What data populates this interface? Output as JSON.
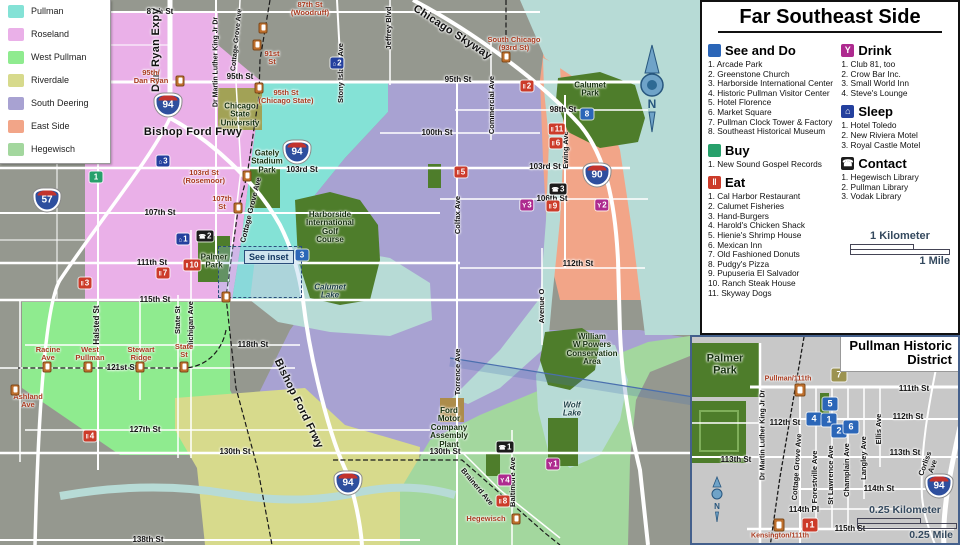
{
  "colors": {
    "see": "#2b66b8",
    "see7": "#9c9350",
    "buy": "#27a06b",
    "eat": "#cc3b2a",
    "drink": "#ae2a8f",
    "sleep": "#24409e",
    "contact": "#1c1c1c",
    "station": "#c0702d"
  },
  "marker_glyphs": {
    "see": "",
    "see7": "",
    "buy": "",
    "eat": "‖",
    "drink": "Y",
    "sleep": "⌂",
    "contact": "☎"
  },
  "legend": {
    "items": [
      {
        "label": "Pullman",
        "color": "#84e2d6"
      },
      {
        "label": "Roseland",
        "color": "#eab0e8"
      },
      {
        "label": "West Pullman",
        "color": "#8feb8f"
      },
      {
        "label": "Riverdale",
        "color": "#d7da8c"
      },
      {
        "label": "South Deering",
        "color": "#a8a2d2"
      },
      {
        "label": "East Side",
        "color": "#f2a588"
      },
      {
        "label": "Hegewisch",
        "color": "#a3d79e"
      }
    ]
  },
  "panel": {
    "title": "Far Southeast Side",
    "sections": [
      {
        "key": "see",
        "col": "left",
        "title": "See and Do",
        "color": "#2b66b8",
        "glyph": "",
        "items": [
          "Arcade Park",
          "Greenstone Church",
          "Harborside International Center",
          "Historic Pullman Visitor Center",
          "Hotel Florence",
          "Market Square",
          "Pullman Clock Tower & Factory",
          "Southeast Historical Museum"
        ]
      },
      {
        "key": "buy",
        "col": "left",
        "title": "Buy",
        "color": "#27a06b",
        "glyph": "",
        "items": [
          "New Sound Gospel Records"
        ]
      },
      {
        "key": "eat",
        "col": "left",
        "title": "Eat",
        "color": "#cc3b2a",
        "glyph": "‖",
        "items": [
          "Cal Harbor Restaurant",
          "Calumet Fisheries",
          "Hand-Burgers",
          "Harold's Chicken Shack",
          "Hienie's Shrimp House",
          "Mexican Inn",
          "Old Fashioned Donuts",
          "Pudgy's Pizza",
          "Pupuseria El Salvador",
          "Ranch Steak House",
          "Skyway Dogs"
        ]
      },
      {
        "key": "drink",
        "col": "right",
        "title": "Drink",
        "color": "#ae2a8f",
        "glyph": "Y",
        "items": [
          "Club 81, too",
          "Crow Bar Inc.",
          "Small World Inn",
          "Steve's Lounge"
        ]
      },
      {
        "key": "sleep",
        "col": "right",
        "title": "Sleep",
        "color": "#24409e",
        "glyph": "⌂",
        "items": [
          "Hotel Toledo",
          "New Riviera Motel",
          "Royal Castle Motel"
        ]
      },
      {
        "key": "contact",
        "col": "right",
        "title": "Contact",
        "color": "#1c1c1c",
        "glyph": "☎",
        "items": [
          "Hegewisch Library",
          "Pullman Library",
          "Vodak Library"
        ]
      }
    ],
    "scale": {
      "km": "1 Kilometer",
      "mile": "1 Mile"
    }
  },
  "map": {
    "compass_n": "N",
    "see_inset_label": "See inset",
    "labels": [
      {
        "t": "87th St",
        "x": 160,
        "y": 12
      },
      {
        "t": "95th St",
        "x": 240,
        "y": 77
      },
      {
        "t": "95th St",
        "x": 458,
        "y": 80
      },
      {
        "t": "98th St",
        "x": 563,
        "y": 110
      },
      {
        "t": "100th St",
        "x": 437,
        "y": 133
      },
      {
        "t": "103rd St",
        "x": 302,
        "y": 170
      },
      {
        "t": "103rd St",
        "x": 545,
        "y": 167
      },
      {
        "t": "106th St",
        "x": 552,
        "y": 199
      },
      {
        "t": "107th St",
        "x": 160,
        "y": 213
      },
      {
        "t": "111th St",
        "x": 152,
        "y": 263
      },
      {
        "t": "112th St",
        "x": 578,
        "y": 264
      },
      {
        "t": "115th St",
        "x": 155,
        "y": 300
      },
      {
        "t": "118th St",
        "x": 253,
        "y": 345
      },
      {
        "t": "121st St",
        "x": 122,
        "y": 368
      },
      {
        "t": "127th St",
        "x": 145,
        "y": 430
      },
      {
        "t": "130th St",
        "x": 235,
        "y": 452
      },
      {
        "t": "130th St",
        "x": 445,
        "y": 452
      },
      {
        "t": "138th St",
        "x": 148,
        "y": 540
      },
      {
        "t": "Halsted St",
        "x": 97,
        "y": 325,
        "r": -90
      },
      {
        "t": "State St",
        "x": 178,
        "y": 320,
        "r": -90,
        "f": 7.5
      },
      {
        "t": "Michigan Ave",
        "x": 191,
        "y": 325,
        "r": -90,
        "f": 7.5
      },
      {
        "t": "Dr Martin Luther King Jr Dr",
        "x": 216,
        "y": 62,
        "r": -90,
        "f": 7
      },
      {
        "t": "Stony Island Ave",
        "x": 341,
        "y": 73,
        "r": -90,
        "f": 7.5
      },
      {
        "t": "Jeffrey Blvd",
        "x": 389,
        "y": 28,
        "r": -90,
        "f": 7.5
      },
      {
        "t": "Commercial Ave",
        "x": 492,
        "y": 105,
        "r": -90,
        "f": 7.5
      },
      {
        "t": "Ewing Ave",
        "x": 566,
        "y": 150,
        "r": -90,
        "f": 7.5
      },
      {
        "t": "Colfax Ave",
        "x": 458,
        "y": 215,
        "r": -90,
        "f": 7.5
      },
      {
        "t": "Torrence Ave",
        "x": 458,
        "y": 372,
        "r": -90,
        "f": 7.5
      },
      {
        "t": "Avenue O",
        "x": 542,
        "y": 306,
        "r": -90,
        "f": 7.5
      },
      {
        "t": "Baltimore Ave",
        "x": 513,
        "y": 482,
        "r": -90,
        "f": 7.5
      },
      {
        "t": "Brainerd Ave",
        "x": 477,
        "y": 487,
        "r": 50,
        "f": 7.5
      },
      {
        "t": "Cottage Grove Ave",
        "x": 237,
        "y": 40,
        "r": -84,
        "f": 7
      },
      {
        "t": "Cottage Grove Ave",
        "x": 251,
        "y": 210,
        "r": -76,
        "f": 7.5
      },
      {
        "t": "Dan Ryan Expy",
        "x": 157,
        "y": 50,
        "r": -90,
        "c": "ex"
      },
      {
        "t": "Bishop Ford Frwy",
        "x": 193,
        "y": 133,
        "c": "ex"
      },
      {
        "t": "Bishop Ford Frwy",
        "x": 298,
        "y": 404,
        "r": 64,
        "c": "ex"
      },
      {
        "t": "Chicago Skyway",
        "x": 452,
        "y": 33,
        "r": 33,
        "c": "ex"
      },
      {
        "t": "95th/\nDan Ryan",
        "x": 151,
        "y": 77,
        "c": "stn"
      },
      {
        "t": "87th St\n(Woodruff)",
        "x": 310,
        "y": 9,
        "c": "stn"
      },
      {
        "t": "91st\nSt",
        "x": 272,
        "y": 58,
        "c": "stn"
      },
      {
        "t": "95th St\n(Chicago State)",
        "x": 286,
        "y": 97,
        "c": "stn"
      },
      {
        "t": "103rd St\n(Rosemoor)",
        "x": 204,
        "y": 177,
        "c": "stn"
      },
      {
        "t": "107th\nSt",
        "x": 222,
        "y": 203,
        "c": "stn"
      },
      {
        "t": "South Chicago\n(93rd St)",
        "x": 514,
        "y": 44,
        "c": "stn"
      },
      {
        "t": "Racine\nAve",
        "x": 48,
        "y": 354,
        "c": "stn"
      },
      {
        "t": "West\nPullman",
        "x": 90,
        "y": 354,
        "c": "stn"
      },
      {
        "t": "Stewart\nRidge",
        "x": 141,
        "y": 354,
        "c": "stn"
      },
      {
        "t": "State\nSt",
        "x": 184,
        "y": 351,
        "c": "stn"
      },
      {
        "t": "Ashland\nAve",
        "x": 28,
        "y": 401,
        "c": "stn"
      },
      {
        "t": "Hegewisch",
        "x": 486,
        "y": 519,
        "c": "stn"
      },
      {
        "t": "Chicago\nState\nUniversity",
        "x": 240,
        "y": 115,
        "c": "ar"
      },
      {
        "t": "Gately\nStadium\nPark",
        "x": 267,
        "y": 162,
        "c": "ar"
      },
      {
        "t": "Palmer\nPark",
        "x": 214,
        "y": 262,
        "c": "ar"
      },
      {
        "t": "Harborside\nInternational\nGolf\nCourse",
        "x": 330,
        "y": 228,
        "c": "ar"
      },
      {
        "t": "Calumet\nPark",
        "x": 590,
        "y": 90,
        "c": "ar"
      },
      {
        "t": "William\nW Powers\nConservation\nArea",
        "x": 592,
        "y": 350,
        "c": "ar"
      },
      {
        "t": "Ford\nMotor\nCompany\nAssembly\nPlant",
        "x": 449,
        "y": 428,
        "c": "ar"
      },
      {
        "t": "Calumet\nLake",
        "x": 330,
        "y": 292,
        "c": "wa"
      },
      {
        "t": "Wolf\nLake",
        "x": 572,
        "y": 410,
        "c": "wa"
      }
    ],
    "stations": [
      {
        "x": 180,
        "y": 81
      },
      {
        "x": 263,
        "y": 28
      },
      {
        "x": 257,
        "y": 45
      },
      {
        "x": 259,
        "y": 88
      },
      {
        "x": 247,
        "y": 176
      },
      {
        "x": 238,
        "y": 208
      },
      {
        "x": 506,
        "y": 57
      },
      {
        "x": 47,
        "y": 367
      },
      {
        "x": 88,
        "y": 367
      },
      {
        "x": 140,
        "y": 367
      },
      {
        "x": 184,
        "y": 367
      },
      {
        "x": 15,
        "y": 390
      },
      {
        "x": 516,
        "y": 519
      },
      {
        "x": 226,
        "y": 297
      }
    ],
    "markers": [
      {
        "t": "see",
        "n": "3",
        "x": 302,
        "y": 255
      },
      {
        "t": "see",
        "n": "8",
        "x": 587,
        "y": 114
      },
      {
        "t": "buy",
        "n": "1",
        "x": 96,
        "y": 177
      },
      {
        "t": "eat",
        "n": "2",
        "x": 527,
        "y": 86
      },
      {
        "t": "eat",
        "n": "11",
        "x": 557,
        "y": 129
      },
      {
        "t": "eat",
        "n": "6",
        "x": 556,
        "y": 143
      },
      {
        "t": "eat",
        "n": "5",
        "x": 461,
        "y": 172
      },
      {
        "t": "eat",
        "n": "9",
        "x": 553,
        "y": 206
      },
      {
        "t": "eat",
        "n": "3",
        "x": 85,
        "y": 283
      },
      {
        "t": "eat",
        "n": "10",
        "x": 192,
        "y": 265
      },
      {
        "t": "eat",
        "n": "7",
        "x": 163,
        "y": 273
      },
      {
        "t": "eat",
        "n": "4",
        "x": 90,
        "y": 436
      },
      {
        "t": "eat",
        "n": "8",
        "x": 503,
        "y": 501
      },
      {
        "t": "drink",
        "n": "3",
        "x": 527,
        "y": 205
      },
      {
        "t": "drink",
        "n": "2",
        "x": 602,
        "y": 205
      },
      {
        "t": "drink",
        "n": "1",
        "x": 553,
        "y": 464
      },
      {
        "t": "drink",
        "n": "4",
        "x": 505,
        "y": 480
      },
      {
        "t": "sleep",
        "n": "2",
        "x": 337,
        "y": 63
      },
      {
        "t": "sleep",
        "n": "3",
        "x": 163,
        "y": 161
      },
      {
        "t": "sleep",
        "n": "1",
        "x": 183,
        "y": 239
      },
      {
        "t": "contact",
        "n": "2",
        "x": 205,
        "y": 236
      },
      {
        "t": "contact",
        "n": "3",
        "x": 558,
        "y": 189
      },
      {
        "t": "contact",
        "n": "1",
        "x": 505,
        "y": 447
      }
    ],
    "shields": [
      {
        "n": "94",
        "x": 168,
        "y": 105
      },
      {
        "n": "57",
        "x": 47,
        "y": 200
      },
      {
        "n": "94",
        "x": 297,
        "y": 152
      },
      {
        "n": "90",
        "x": 597,
        "y": 175
      },
      {
        "n": "94",
        "x": 348,
        "y": 483
      }
    ]
  },
  "inset": {
    "title": "Pullman Historic\nDistrict",
    "compass_n": "N",
    "scale": {
      "km": "0.25 Kilometer",
      "mile": "0.25 Mile"
    },
    "labels": [
      {
        "t": "111th St",
        "x": 222,
        "y": 52
      },
      {
        "t": "112th St",
        "x": 216,
        "y": 80
      },
      {
        "t": "112th St",
        "x": 93,
        "y": 86
      },
      {
        "t": "113th St",
        "x": 213,
        "y": 116
      },
      {
        "t": "113th St",
        "x": 44,
        "y": 123
      },
      {
        "t": "114th St",
        "x": 187,
        "y": 152
      },
      {
        "t": "114th Pl",
        "x": 112,
        "y": 173
      },
      {
        "t": "115th St",
        "x": 158,
        "y": 192
      },
      {
        "t": "Dr Martin Luther King Jr Dr",
        "x": 71,
        "y": 98,
        "r": -90,
        "f": 7
      },
      {
        "t": "Cottage Grove Ave",
        "x": 105,
        "y": 130,
        "r": -86,
        "f": 7.5
      },
      {
        "t": "Forestville Ave",
        "x": 123,
        "y": 140,
        "r": -90,
        "f": 7.5
      },
      {
        "t": "St Lawrence Ave",
        "x": 139,
        "y": 138,
        "r": -90,
        "f": 7.5
      },
      {
        "t": "Champlain Ave",
        "x": 155,
        "y": 133,
        "r": -90,
        "f": 7.5
      },
      {
        "t": "Langley Ave",
        "x": 172,
        "y": 121,
        "r": -90,
        "f": 7.5
      },
      {
        "t": "Ellis Ave",
        "x": 187,
        "y": 92,
        "r": -90,
        "f": 7.5
      },
      {
        "t": "Corliss Ave",
        "x": 237,
        "y": 128,
        "r": -70,
        "f": 7.5
      },
      {
        "t": "Palmer\nPark",
        "x": 33,
        "y": 28,
        "c": "ar",
        "f": 11
      },
      {
        "t": "Pullman/111th",
        "x": 96,
        "y": 42,
        "c": "stn",
        "f": 7
      },
      {
        "t": "Kensington/111th",
        "x": 88,
        "y": 199,
        "c": "stn",
        "f": 7
      }
    ],
    "stations": [
      {
        "x": 108,
        "y": 53
      },
      {
        "x": 87,
        "y": 188
      }
    ],
    "markers": [
      {
        "t": "see7",
        "n": "7",
        "x": 147,
        "y": 38
      },
      {
        "t": "see",
        "n": "5",
        "x": 138,
        "y": 67
      },
      {
        "t": "see",
        "n": "4",
        "x": 122,
        "y": 82
      },
      {
        "t": "see",
        "n": "1",
        "x": 137,
        "y": 83
      },
      {
        "t": "see",
        "n": "2",
        "x": 147,
        "y": 94
      },
      {
        "t": "see",
        "n": "6",
        "x": 159,
        "y": 90
      },
      {
        "t": "eat",
        "n": "1",
        "x": 118,
        "y": 188
      }
    ],
    "shields": [
      {
        "n": "94",
        "x": 247,
        "y": 149
      }
    ]
  }
}
